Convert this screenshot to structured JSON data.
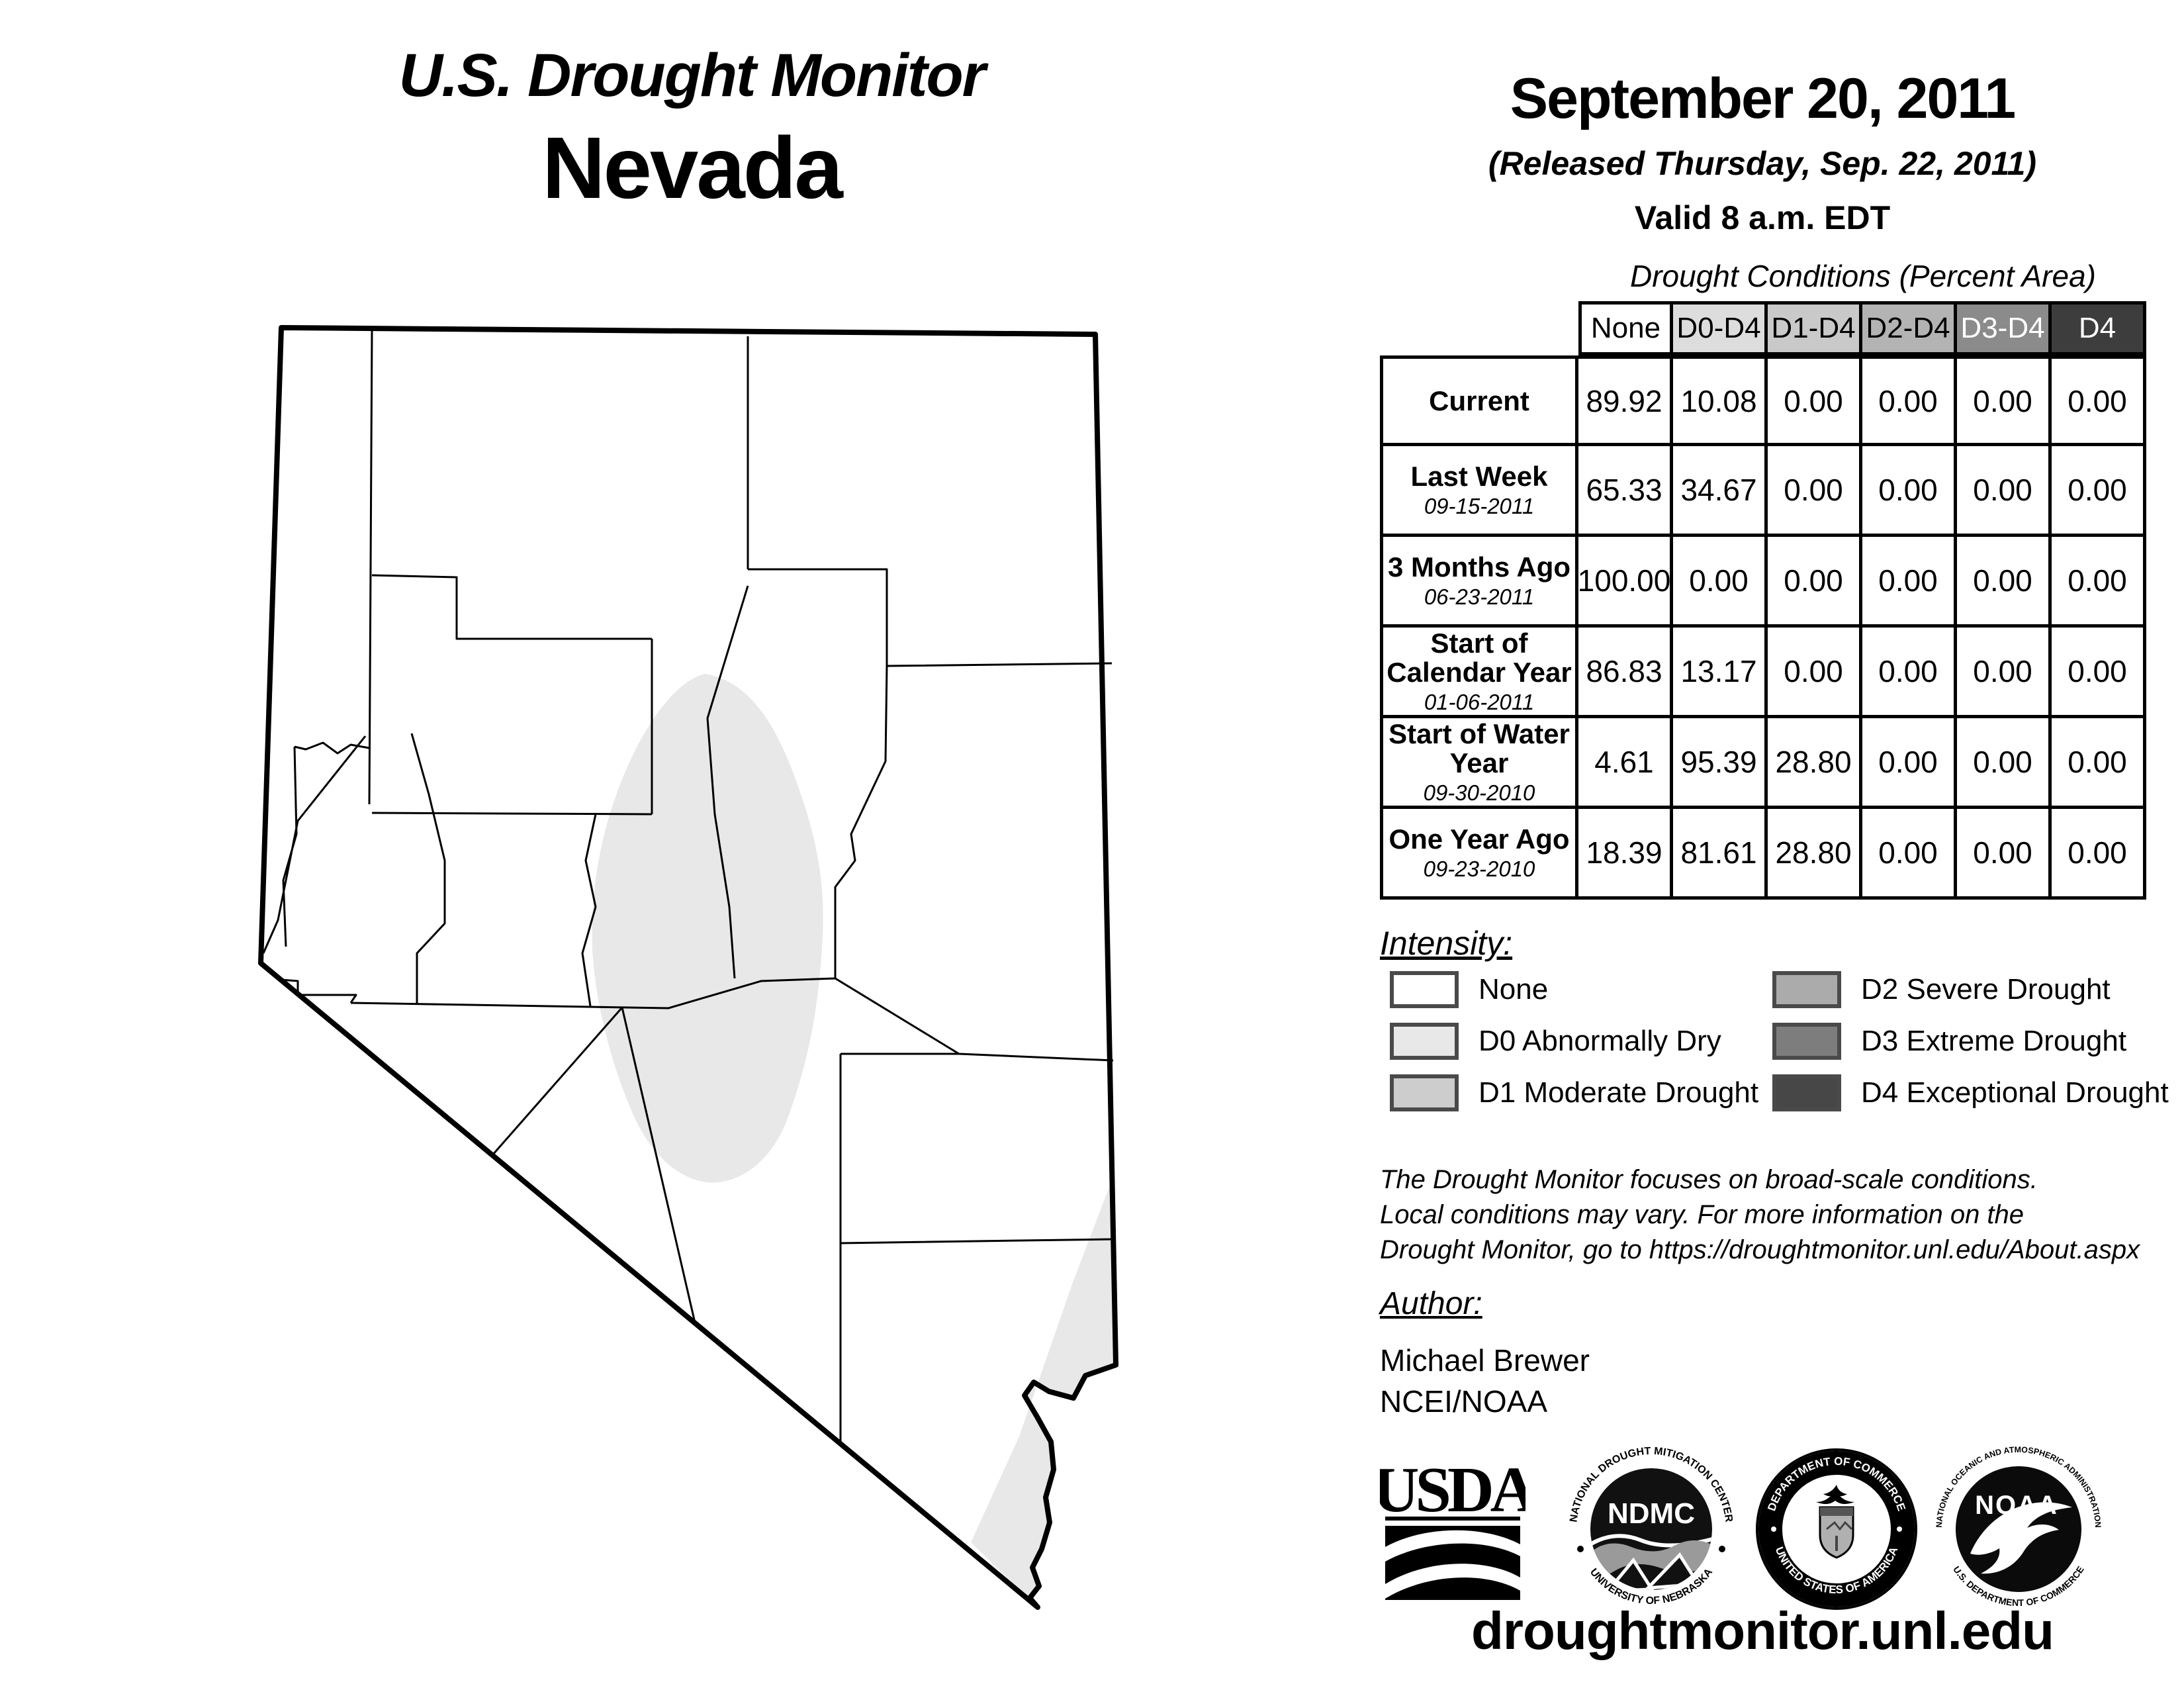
{
  "title": "U.S. Drought Monitor",
  "state": "Nevada",
  "date_block": {
    "date": "September 20, 2011",
    "released": "(Released Thursday, Sep. 22, 2011)",
    "valid": "Valid 8 a.m. EDT"
  },
  "table": {
    "title": "Drought Conditions (Percent Area)",
    "columns": [
      "None",
      "D0-D4",
      "D1-D4",
      "D2-D4",
      "D3-D4",
      "D4"
    ],
    "header_bg": [
      "#ffffff",
      "#dddddd",
      "#c9c9c9",
      "#b3b3b3",
      "#8b8b8b",
      "#3d3d3d"
    ],
    "header_fg": [
      "#000000",
      "#000000",
      "#000000",
      "#000000",
      "#ffffff",
      "#ffffff"
    ],
    "rows": [
      {
        "label": "Current",
        "date": "",
        "values": [
          "89.92",
          "10.08",
          "0.00",
          "0.00",
          "0.00",
          "0.00"
        ]
      },
      {
        "label": "Last Week",
        "date": "09-15-2011",
        "values": [
          "65.33",
          "34.67",
          "0.00",
          "0.00",
          "0.00",
          "0.00"
        ]
      },
      {
        "label": "3 Months Ago",
        "date": "06-23-2011",
        "values": [
          "100.00",
          "0.00",
          "0.00",
          "0.00",
          "0.00",
          "0.00"
        ]
      },
      {
        "label": "Start of Calendar Year",
        "date": "01-06-2011",
        "values": [
          "86.83",
          "13.17",
          "0.00",
          "0.00",
          "0.00",
          "0.00"
        ]
      },
      {
        "label": "Start of Water Year",
        "date": "09-30-2010",
        "values": [
          "4.61",
          "95.39",
          "28.80",
          "0.00",
          "0.00",
          "0.00"
        ]
      },
      {
        "label": "One Year Ago",
        "date": "09-23-2010",
        "values": [
          "18.39",
          "81.61",
          "28.80",
          "0.00",
          "0.00",
          "0.00"
        ]
      }
    ]
  },
  "legend": {
    "heading": "Intensity:",
    "items": [
      {
        "label": "None",
        "color": "#ffffff"
      },
      {
        "label": "D0 Abnormally Dry",
        "color": "#e8e8e8"
      },
      {
        "label": "D1 Moderate Drought",
        "color": "#cdcdcd"
      },
      {
        "label": "D2 Severe Drought",
        "color": "#ababab"
      },
      {
        "label": "D3 Extreme Drought",
        "color": "#7d7d7d"
      },
      {
        "label": "D4 Exceptional Drought",
        "color": "#474747"
      }
    ],
    "swatch_border": "#4a4a4a"
  },
  "disclaimer": {
    "lines": [
      "The Drought Monitor focuses on broad-scale conditions.",
      "Local conditions may vary. For more information on the",
      "Drought Monitor, go to https://droughtmonitor.unl.edu/About.aspx"
    ]
  },
  "author_block": {
    "heading": "Author:",
    "name": "Michael Brewer",
    "org": "NCEI/NOAA"
  },
  "footer_url": "droughtmonitor.unl.edu",
  "logos": {
    "usda": {
      "text": "USDA"
    },
    "ndmc": {
      "center": "NDMC",
      "top": "NATIONAL DROUGHT MITIGATION CENTER",
      "bottom": "UNIVERSITY OF NEBRASKA"
    },
    "doc": {
      "top": "DEPARTMENT OF COMMERCE",
      "bottom": "UNITED STATES OF AMERICA"
    },
    "noaa": {
      "center": "NOAA",
      "top": "NATIONAL OCEANIC AND ATMOSPHERIC ADMINISTRATION",
      "bottom": "U.S. DEPARTMENT OF COMMERCE"
    }
  },
  "map": {
    "state_name": "Nevada",
    "border_color": "#000000"
  }
}
